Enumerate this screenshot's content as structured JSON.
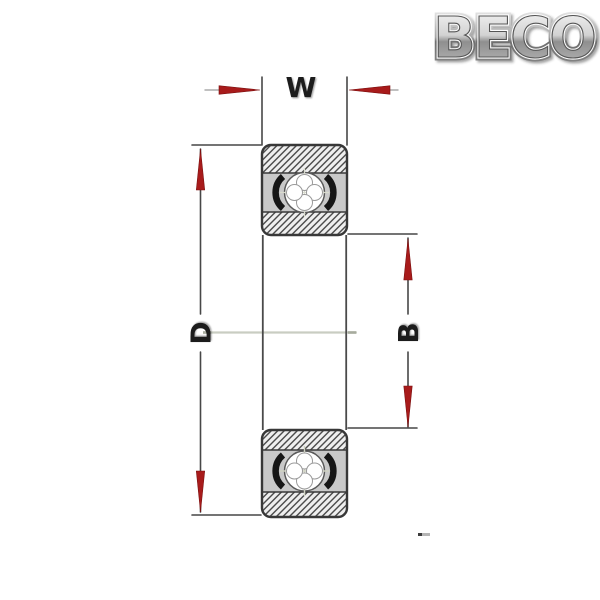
{
  "logo": {
    "text": "BECO"
  },
  "diagram": {
    "type": "bearing-cross-section-drawing",
    "dimension_labels": {
      "width": "W",
      "outer_diameter": "D",
      "bore": "B"
    }
  },
  "colors": {
    "arrow_red": "#a81b1b",
    "line_dark": "#3f3f3f",
    "label_text": "#1f1f1f",
    "centerline": "#c9cdc2",
    "seal_black": "#161616",
    "hatch_line": "#4c4c4c",
    "background": "#ffffff"
  }
}
